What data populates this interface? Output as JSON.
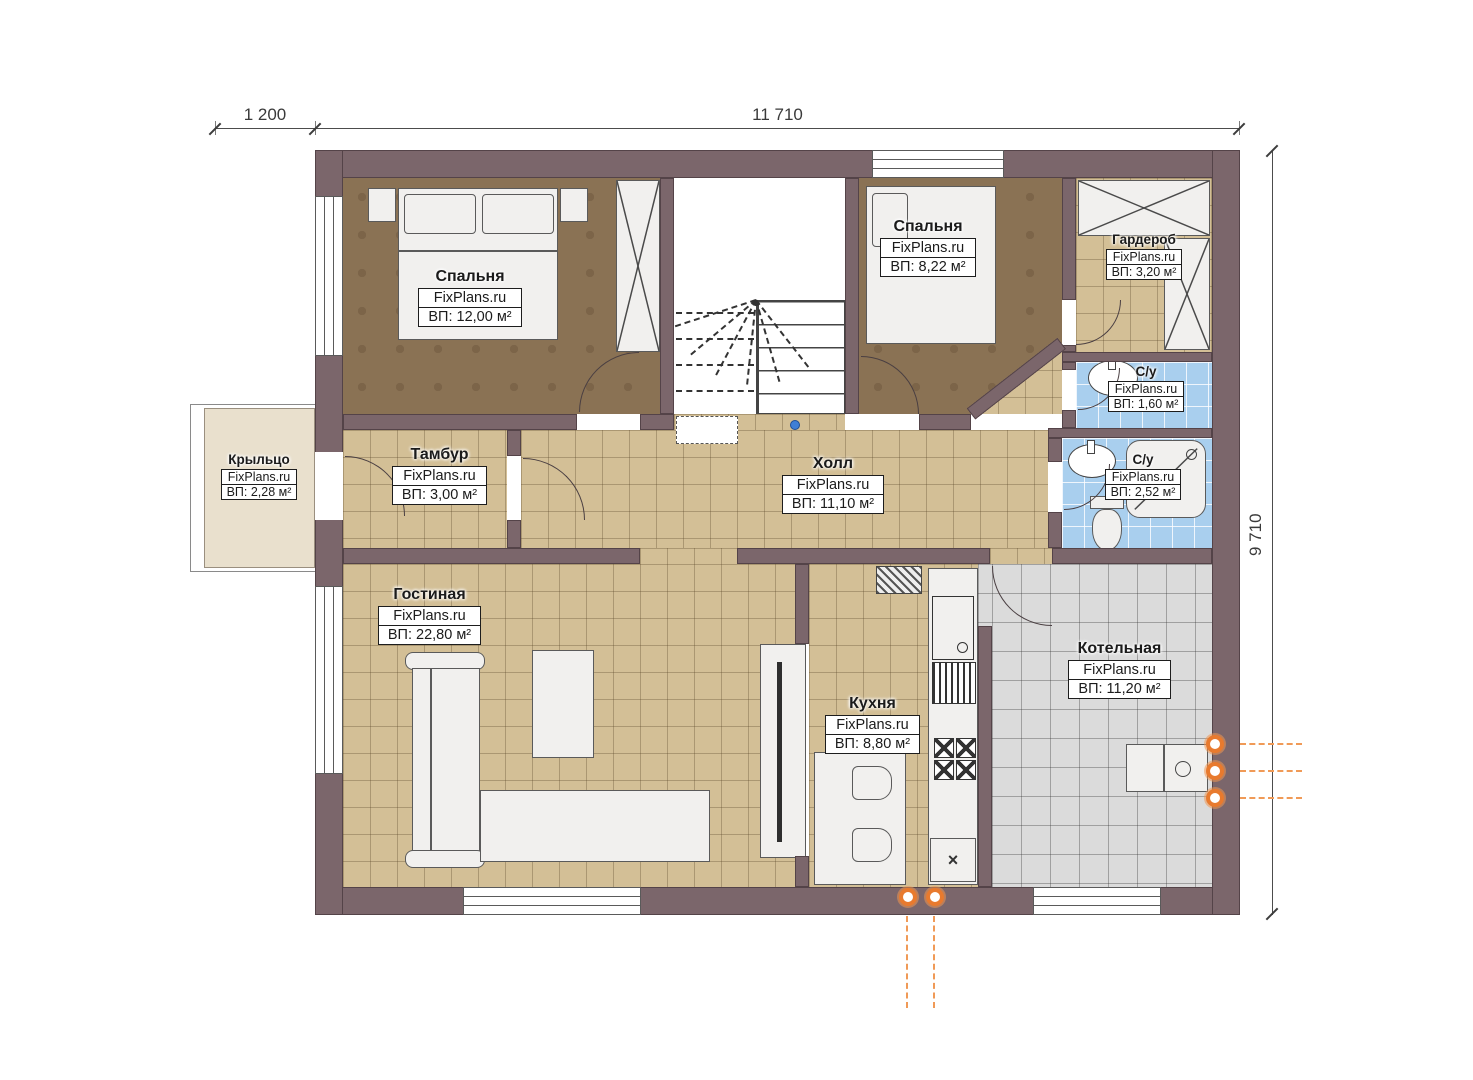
{
  "watermark": "FixPlans.ru",
  "dimensions": {
    "top_left": "1 200",
    "top_width": "11 710",
    "right_height": "9 710"
  },
  "rooms": [
    {
      "id": "porch",
      "name": "Крыльцо",
      "watermark": "FixPlans.ru",
      "area": "ВП: 2,28 м²"
    },
    {
      "id": "bedroom1",
      "name": "Спальня",
      "watermark": "FixPlans.ru",
      "area": "ВП: 12,00 м²"
    },
    {
      "id": "bedroom2",
      "name": "Спальня",
      "watermark": "FixPlans.ru",
      "area": "ВП: 8,22 м²"
    },
    {
      "id": "wardrobe",
      "name": "Гардероб",
      "watermark": "FixPlans.ru",
      "area": "ВП: 3,20 м²"
    },
    {
      "id": "bath1",
      "name": "С/у",
      "watermark": "FixPlans.ru",
      "area": "ВП: 1,60 м²"
    },
    {
      "id": "bath2",
      "name": "С/у",
      "watermark": "FixPlans.ru",
      "area": "ВП: 2,52 м²"
    },
    {
      "id": "tambour",
      "name": "Тамбур",
      "watermark": "FixPlans.ru",
      "area": "ВП: 3,00 м²"
    },
    {
      "id": "hall",
      "name": "Холл",
      "watermark": "FixPlans.ru",
      "area": "ВП: 11,10 м²"
    },
    {
      "id": "living",
      "name": "Гостиная",
      "watermark": "FixPlans.ru",
      "area": "ВП: 22,80 м²"
    },
    {
      "id": "kitchen",
      "name": "Кухня",
      "watermark": "FixPlans.ru",
      "area": "ВП: 8,80 м²"
    },
    {
      "id": "boiler",
      "name": "Котельная",
      "watermark": "FixPlans.ru",
      "area": "ВП: 11,20 м²"
    }
  ],
  "symbols": {
    "kitchen_vent": "×"
  },
  "colors": {
    "wall": "#7b666b",
    "floor_tan": "#d3bf96",
    "floor_brown": "#8a7254",
    "floor_gray": "#dbdbdb",
    "floor_blue": "#a9cfee",
    "porch": "#e9e0cd",
    "marker_orange": "#e87a2e"
  }
}
